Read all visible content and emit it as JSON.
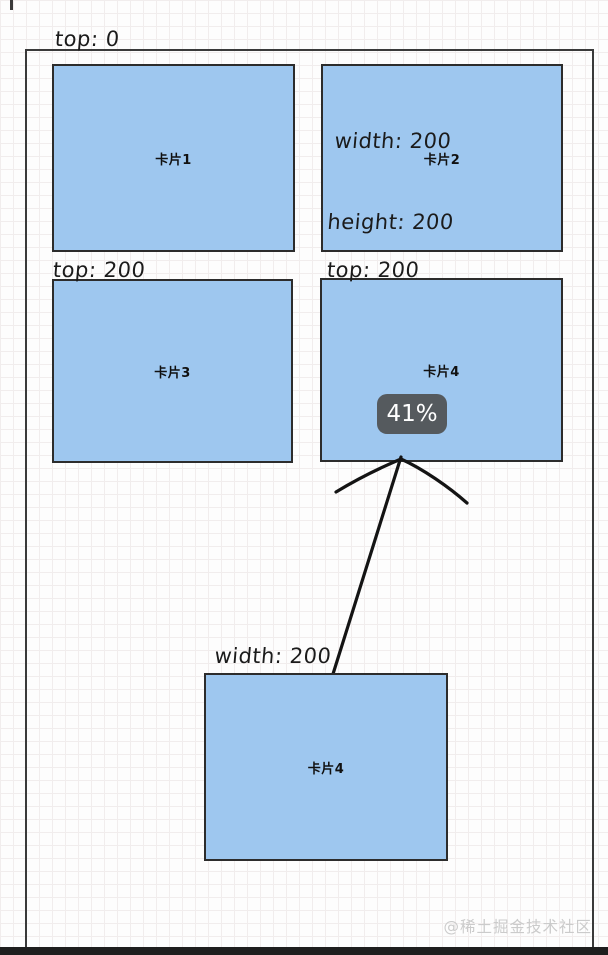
{
  "cards": [
    {
      "label": "卡片1"
    },
    {
      "label": "卡片2"
    },
    {
      "label": "卡片3"
    },
    {
      "label": "卡片4"
    },
    {
      "label": "卡片4"
    }
  ],
  "annotations": {
    "top_zero": "top: 0",
    "top_200_left": "top: 200",
    "top_200_right": "top: 200",
    "card2_dims_line1": "width: 200",
    "card2_dims_line2": "height: 200",
    "bottom_dims_line1": "width: 200",
    "bottom_dims_line2": "height:  200"
  },
  "tooltip": {
    "text": "41%"
  },
  "watermark": {
    "text": "@稀土掘金技术社区"
  },
  "colors": {
    "card_fill": "#9ec7ef",
    "card_border": "#2c2c2c",
    "container_border": "#3a3a3a",
    "bottom_bar": "#1e1e1e",
    "tooltip_bg": "#555a5e",
    "tooltip_text": "#ffffff",
    "annotation": "#1b1b1b",
    "arrow": "#141414",
    "watermark": "#cbcbcb",
    "grid_line": "#f1eded"
  }
}
